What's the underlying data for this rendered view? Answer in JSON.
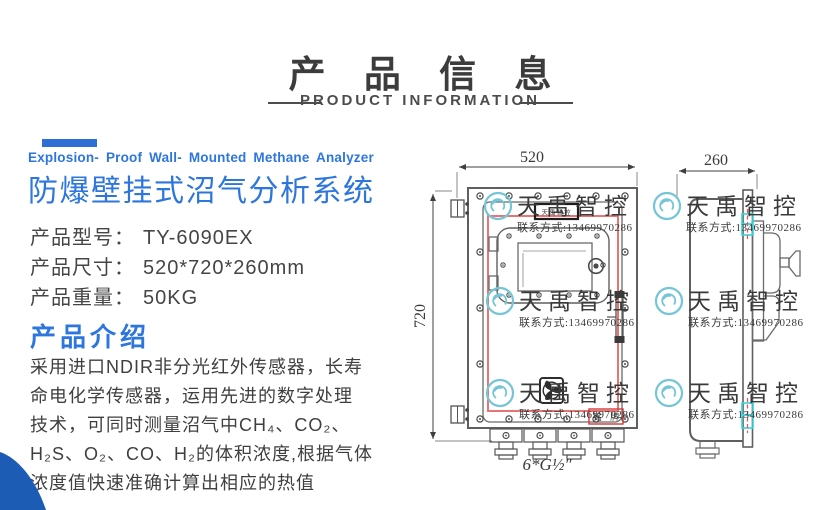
{
  "header": {
    "title": "产 品 信 息",
    "subtitle": "PRODUCT INFORMATION"
  },
  "product": {
    "tagline_en": "Explosion- Proof Wall- Mounted Methane Analyzer",
    "title_cn": "防爆壁挂式沼气分析系统",
    "specs": [
      {
        "label": "产品型号：",
        "value": "TY-6090EX"
      },
      {
        "label": "产品尺寸：",
        "value": "520*720*260mm"
      },
      {
        "label": "产品重量：",
        "value": "50KG"
      }
    ],
    "intro_heading": "产品介绍",
    "intro_lines": [
      "采用进口NDIR非分光红外传感器，长寿",
      "命电化学传感器，运用先进的数字处理",
      "技术，可同时测量沼气中CH₄、CO₂、",
      "H₂S、O₂、CO、H₂的体积浓度,根据气体",
      "浓度值快速准确计算出相应的热值"
    ]
  },
  "drawing": {
    "front_width_mm": "520",
    "front_height_mm": "720",
    "side_depth_mm": "260",
    "gland_spec": "6*G½″",
    "nameplate": "铭 牌",
    "label_plate": "天禹智控"
  },
  "watermark": {
    "brand": "天禹智控",
    "contact": "联系方式:13469970286"
  },
  "colors": {
    "accent_blue": "#2d76dd",
    "bar_blue": "#2e6fd6",
    "corner_blue": "#1d5cb5",
    "drawing_red": "#e87474",
    "nameplate_red": "#cf3a3a",
    "highlight_teal": "#35d6de",
    "watermark_teal": "#74c5d6",
    "text_dark": "#3c3c3c"
  }
}
